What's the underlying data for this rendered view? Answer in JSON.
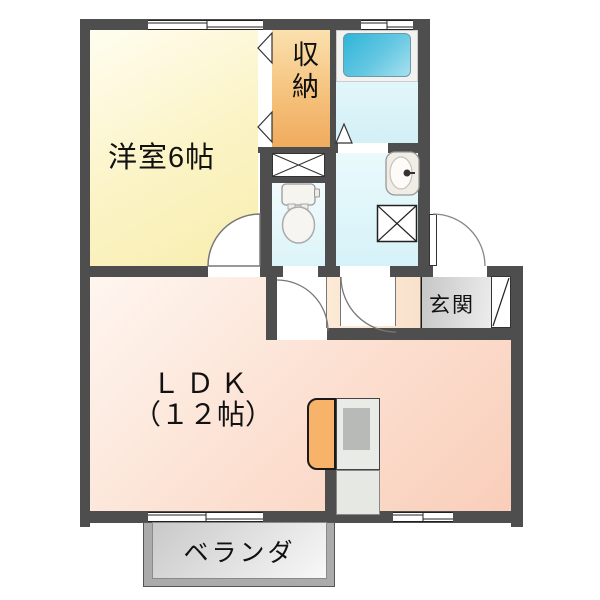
{
  "plan": {
    "rooms": {
      "western_room": {
        "label": "洋室6帖",
        "color": "#f8eeb0"
      },
      "storage": {
        "label": "収納",
        "color": "#f0ab5e"
      },
      "bathroom": {
        "color": "#d2f0f6"
      },
      "washroom": {
        "color": "#d6f2f8"
      },
      "toilet": {
        "color": "#dcf4f8"
      },
      "hallway": {
        "color": "#f9e2cc"
      },
      "entrance": {
        "label": "玄関",
        "color": "#d9d9d9"
      },
      "ldk": {
        "label_line1": "ＬＤＫ",
        "label_line2": "（１２帖）",
        "color": "#f9ceba"
      },
      "veranda": {
        "label": "ベランダ",
        "color": "#c9c9c9"
      }
    },
    "fixtures": {
      "icons": [
        "bathtub-icon",
        "toilet-icon",
        "washbasin-icon",
        "washing-machine-icon",
        "storage-x-icon",
        "kitchen-counter-icon",
        "stove-icon",
        "door-arc-icon",
        "folding-door-icon",
        "entrance-door-icon"
      ]
    },
    "colors": {
      "wall": "#4e4e4e",
      "bathtub": "#2fb4d8",
      "kitchen_counter": "#f7b369"
    }
  }
}
